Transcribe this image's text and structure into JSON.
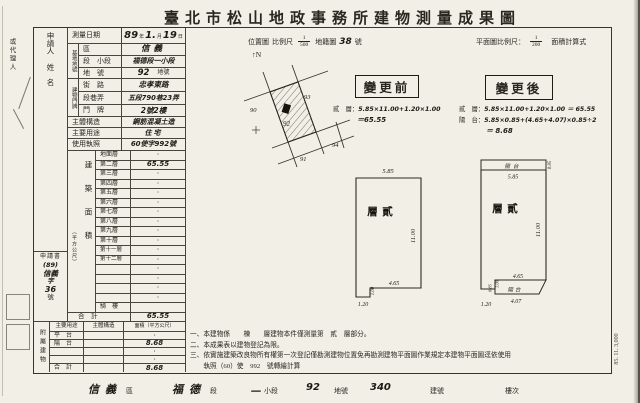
{
  "title": "臺北市松山地政事務所建物測量成果圖",
  "margin": {
    "agent_label": "或代理人",
    "print_code": "85. 11. 3,000"
  },
  "applicant": {
    "label_1": "申請人",
    "label_2": "姓　名",
    "doc_label": "申請書",
    "doc_no": [
      "(89)",
      "信義",
      "字",
      "36",
      "號"
    ]
  },
  "survey_date": {
    "label": "測量日期",
    "year": "89",
    "year_u": "年",
    "month": "1.",
    "month_u": "月",
    "day": "19",
    "day_u": "日"
  },
  "site": {
    "group": "基地地號",
    "rows": [
      {
        "label": "區",
        "value": "信義"
      },
      {
        "label": "段　小段",
        "value": "福德段一小段"
      },
      {
        "label": "地　號",
        "value": "92",
        "suffix": "地號"
      }
    ]
  },
  "address": {
    "group": "建物門牌",
    "rows": [
      {
        "label": "街　路",
        "value": "忠孝東路"
      },
      {
        "label": "段巷弄",
        "value": "五段790巷23弄"
      },
      {
        "label": "門　牌",
        "value": "2號2樓"
      }
    ]
  },
  "structure": {
    "label": "主體構造",
    "value": "鋼筋混凝土造"
  },
  "usage": {
    "label": "主要用途",
    "value": "住宅"
  },
  "license": {
    "label": "使用執照",
    "value": "60使字992號"
  },
  "floor_area": {
    "label": "建築面積",
    "unit": "（平方公尺）",
    "rows": [
      {
        "label": "地面層",
        "value": "·"
      },
      {
        "label": "第二層",
        "value": "65.55"
      },
      {
        "label": "第三層",
        "value": "·"
      },
      {
        "label": "第四層",
        "value": "·"
      },
      {
        "label": "第五層",
        "value": "·"
      },
      {
        "label": "第六層",
        "value": "·"
      },
      {
        "label": "第七層",
        "value": "·"
      },
      {
        "label": "第八層",
        "value": "·"
      },
      {
        "label": "第九層",
        "value": "·"
      },
      {
        "label": "第十層",
        "value": "·"
      },
      {
        "label": "第十一層",
        "value": "·"
      },
      {
        "label": "第十二層",
        "value": "·"
      },
      {
        "label": "",
        "value": "·"
      },
      {
        "label": "",
        "value": "·"
      },
      {
        "label": "",
        "value": "·"
      },
      {
        "label": "",
        "value": "·"
      },
      {
        "label": "騎　樓",
        "value": ""
      },
      {
        "label": "合　計",
        "value": "65.55"
      }
    ]
  },
  "annex": {
    "label": "附屬建物",
    "headers": [
      "主要用途",
      "主體構造",
      "面積（平方公尺）"
    ],
    "rows": [
      {
        "use": "平　台",
        "structure": "",
        "area": "·"
      },
      {
        "use": "陽　台",
        "structure": "",
        "area": "8.68"
      },
      {
        "use": "",
        "structure": "",
        "area": "·"
      },
      {
        "use": "",
        "structure": "",
        "area": "·"
      },
      {
        "use": "合　計",
        "structure": "",
        "area": "8.68"
      }
    ]
  },
  "map_header": {
    "location": "位置圖",
    "scale_label": "比例尺",
    "scale_num": "1",
    "scale_den": "500",
    "cadastral": "地籍圖",
    "sheet_no": "38",
    "sheet_u": "號",
    "north": "↑N"
  },
  "plan_header": {
    "label": "平面圖比例尺：",
    "num": "1",
    "den": "200",
    "calc": "面積計算式"
  },
  "location_map": {
    "parcel": "92",
    "n_left": "90",
    "n_top": "93",
    "n_bottom": "91",
    "n_right": "94"
  },
  "before": {
    "title": "變更前",
    "l1_label": "貳　層：",
    "l1": "5.85×11.00+1.20×1.00",
    "l2": "＝65.55"
  },
  "after": {
    "title": "變更後",
    "l1_label": "貳　層：",
    "l1": "5.85×11.00+1.20×1.00 ＝ 65.55",
    "l2_label": "陽　台：",
    "l2": "5.85×0.85+(4.65+4.07)×0.85÷2",
    "l3": "＝ 8.68"
  },
  "before_plan": {
    "room": "貳層",
    "top": "5.85",
    "right": "11.00",
    "bottom": "4.65",
    "notch_w": "1.20",
    "notch_h": "1.00"
  },
  "after_plan": {
    "room": "貳層",
    "top_balcony": "陽台",
    "top": "5.85",
    "balcony_h_top": "0.85",
    "right": "11.00",
    "bottom": "4.65",
    "bottom_balcony": "陽台",
    "balcony_bottom": "4.07",
    "notch_w": "1.20",
    "balcony_h_bottom": "0.85",
    "notch_h": "1.00"
  },
  "notes": [
    "一、本建物係　　棟　　層建物本件僅測量第　貳　層部分。",
    "二、本成果表以建物登記為限。",
    "三、依實施建築改良物所有權第一次登記僅勘測建物位置免再勘測建物平面圖作業規定本建物平面圖逕依使用",
    "　　執照（60）使　992　號轉繪計算"
  ],
  "footer": {
    "district": "信義",
    "district_u": "區",
    "section": "福德",
    "section_u": "段",
    "subsection": "一",
    "subsection_u": "小段",
    "parcel": "92",
    "parcel_u": "地號",
    "building": "340",
    "building_u": "建號",
    "floor_u": "樓次"
  }
}
